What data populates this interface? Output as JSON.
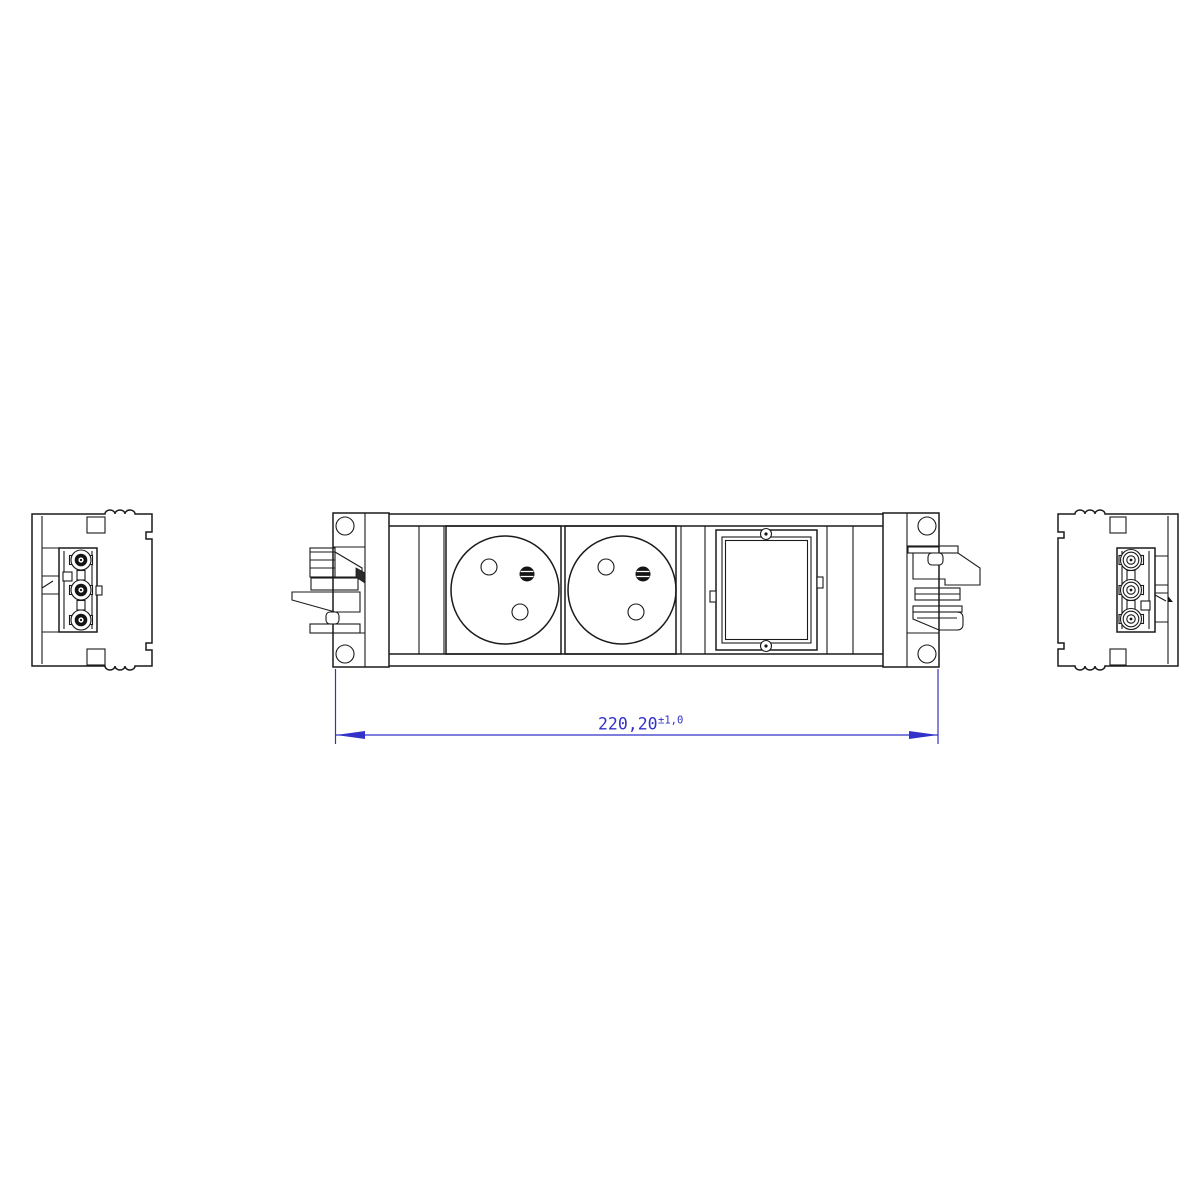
{
  "page": {
    "background_color": "#ffffff"
  },
  "drawing": {
    "line_color": "#1a1a1a",
    "dimension_color": "#3232c8",
    "dimension": {
      "value": "220,20",
      "tolerance": "±1,0",
      "full_label": "220,20±1,0"
    },
    "views": {
      "left_side_view": {
        "terminals": 3
      },
      "front_view": {
        "sockets": 2,
        "blank_modules": 1,
        "mounting_holes": 4,
        "module_screws": 2
      },
      "right_side_view": {
        "terminals": 3
      }
    }
  }
}
